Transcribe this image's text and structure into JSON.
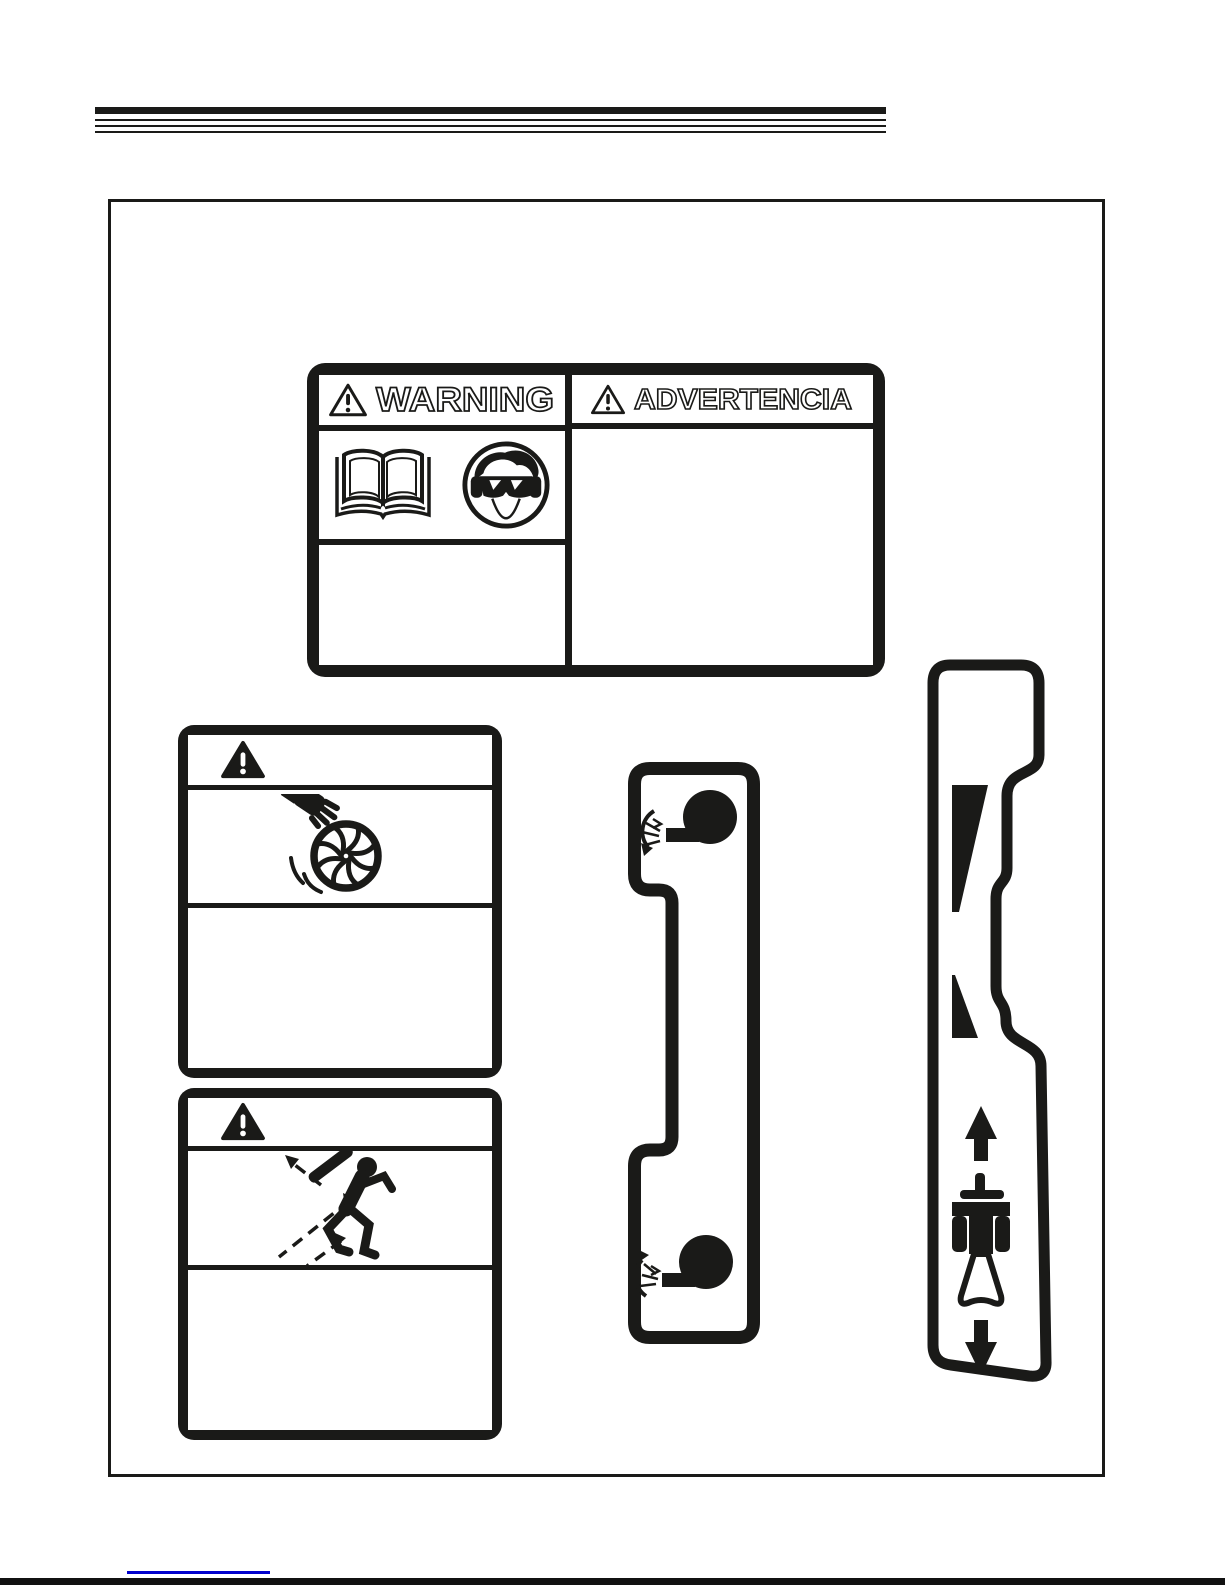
{
  "page": {
    "type": "manual-safety-decals-page",
    "background": "#ffffff",
    "ink_color": "#1a1a18",
    "footer_mark_color": "#0000cc"
  },
  "decals": {
    "bilingual_warning": {
      "english": {
        "signal_word": "WARNING",
        "icons": [
          "warning-triangle-icon",
          "read-manual-book-icon",
          "eye-protection-goggles-icon"
        ]
      },
      "spanish": {
        "signal_word": "ADVERTENCIA",
        "icons": [
          "warning-triangle-icon"
        ]
      }
    },
    "impeller_hazard": {
      "icons": [
        "warning-triangle-icon",
        "hand-in-impeller-icon"
      ]
    },
    "thrown_objects_hazard": {
      "icons": [
        "warning-triangle-icon",
        "thrown-objects-icon"
      ]
    },
    "deflector_control": {
      "icons": [
        "blower-rotate-down-icon",
        "blower-rotate-up-icon"
      ]
    },
    "speed_control": {
      "icons": [
        "speed-wedge-large-icon",
        "speed-wedge-small-icon",
        "up-arrow-icon",
        "walk-behind-machine-icon",
        "down-arrow-icon"
      ]
    }
  }
}
